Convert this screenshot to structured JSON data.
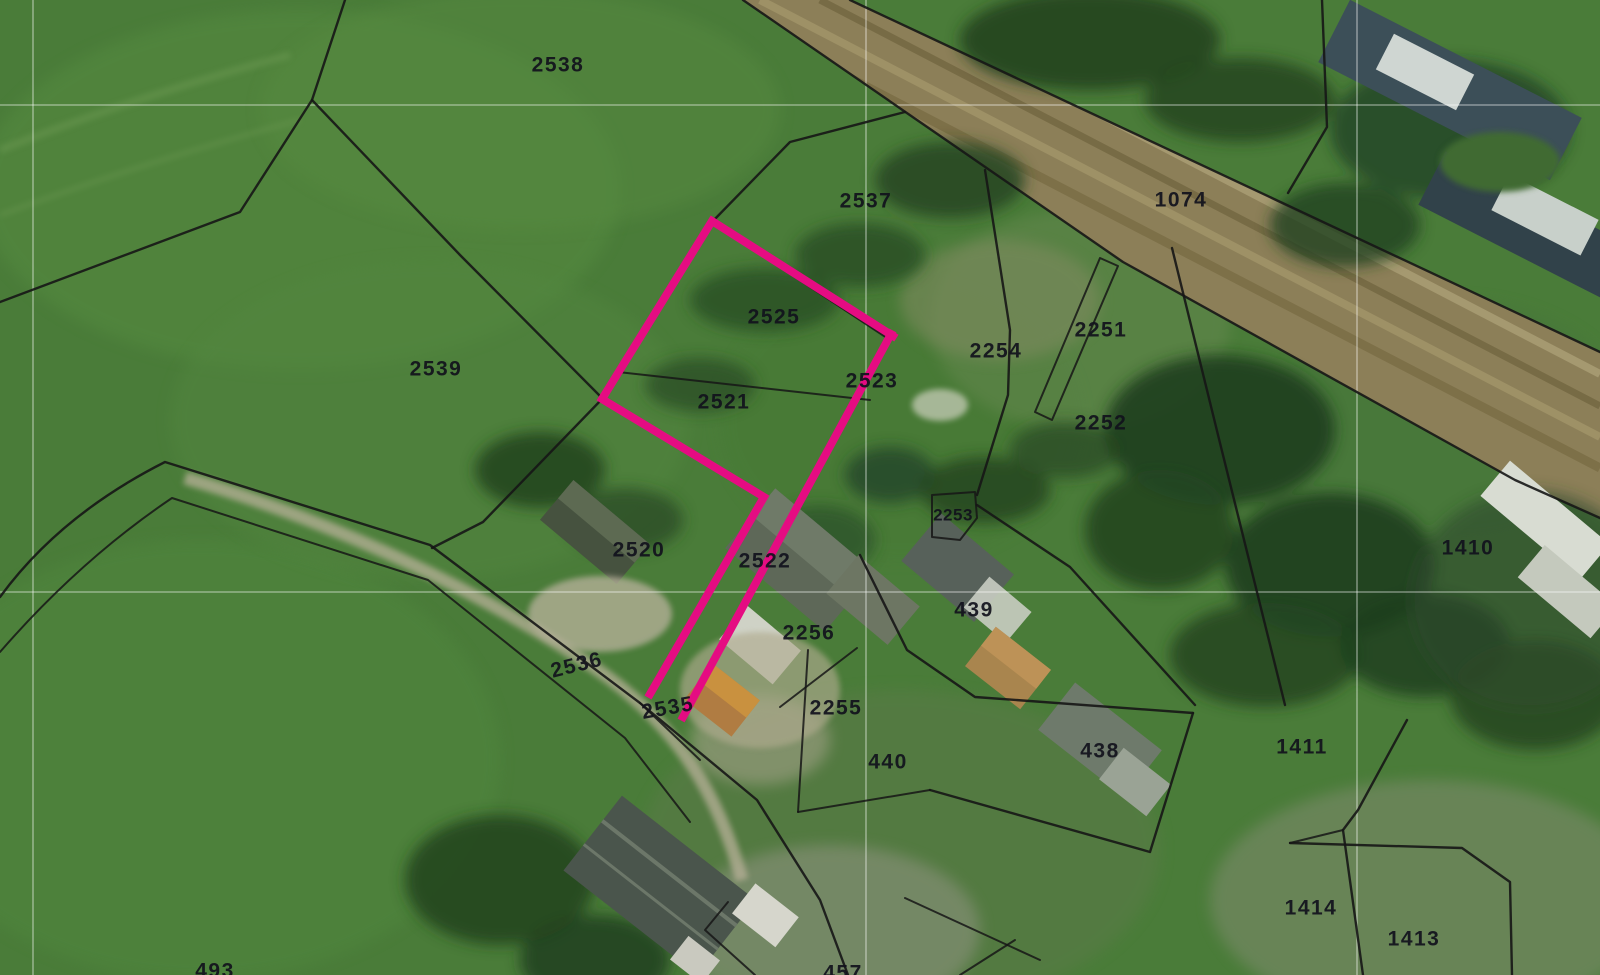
{
  "map": {
    "kind": "cadastral-parcel-overlay-on-satellite",
    "colors": {
      "highlight": "#e50c82",
      "boundary": "#161616",
      "grid": "#ffffff",
      "label": "#12121d",
      "field_green": "#4a7c39",
      "road_brown": "#8c7f58"
    },
    "highlighted_parcels_note": "open magenta outline around parcels 2525 / 2521 / 2522",
    "parcels": [
      {
        "id": "2538",
        "x": 558,
        "y": 66
      },
      {
        "id": "2537",
        "x": 866,
        "y": 202
      },
      {
        "id": "1074",
        "x": 1181,
        "y": 201
      },
      {
        "id": "2525",
        "x": 774,
        "y": 318
      },
      {
        "id": "2251",
        "x": 1101,
        "y": 331
      },
      {
        "id": "2254",
        "x": 996,
        "y": 352
      },
      {
        "id": "2539",
        "x": 436,
        "y": 370
      },
      {
        "id": "2523",
        "x": 872,
        "y": 382
      },
      {
        "id": "2521",
        "x": 724,
        "y": 403
      },
      {
        "id": "2252",
        "x": 1101,
        "y": 424
      },
      {
        "id": "2253",
        "x": 953,
        "y": 516,
        "small": true
      },
      {
        "id": "2520",
        "x": 639,
        "y": 551
      },
      {
        "id": "2522",
        "x": 765,
        "y": 562
      },
      {
        "id": "1410",
        "x": 1468,
        "y": 549
      },
      {
        "id": "439",
        "x": 974,
        "y": 611
      },
      {
        "id": "2256",
        "x": 809,
        "y": 634
      },
      {
        "id": "2536",
        "x": 577,
        "y": 666,
        "rotate": -14
      },
      {
        "id": "2535",
        "x": 668,
        "y": 709,
        "rotate": -10
      },
      {
        "id": "2255",
        "x": 836,
        "y": 709
      },
      {
        "id": "440",
        "x": 888,
        "y": 763
      },
      {
        "id": "438",
        "x": 1100,
        "y": 752
      },
      {
        "id": "1411",
        "x": 1302,
        "y": 748
      },
      {
        "id": "1414",
        "x": 1311,
        "y": 909
      },
      {
        "id": "1413",
        "x": 1414,
        "y": 940
      },
      {
        "id": "493",
        "x": 215,
        "y": 972,
        "clipped": true
      },
      {
        "id": "457",
        "x": 843,
        "y": 974,
        "clipped": true
      }
    ]
  }
}
